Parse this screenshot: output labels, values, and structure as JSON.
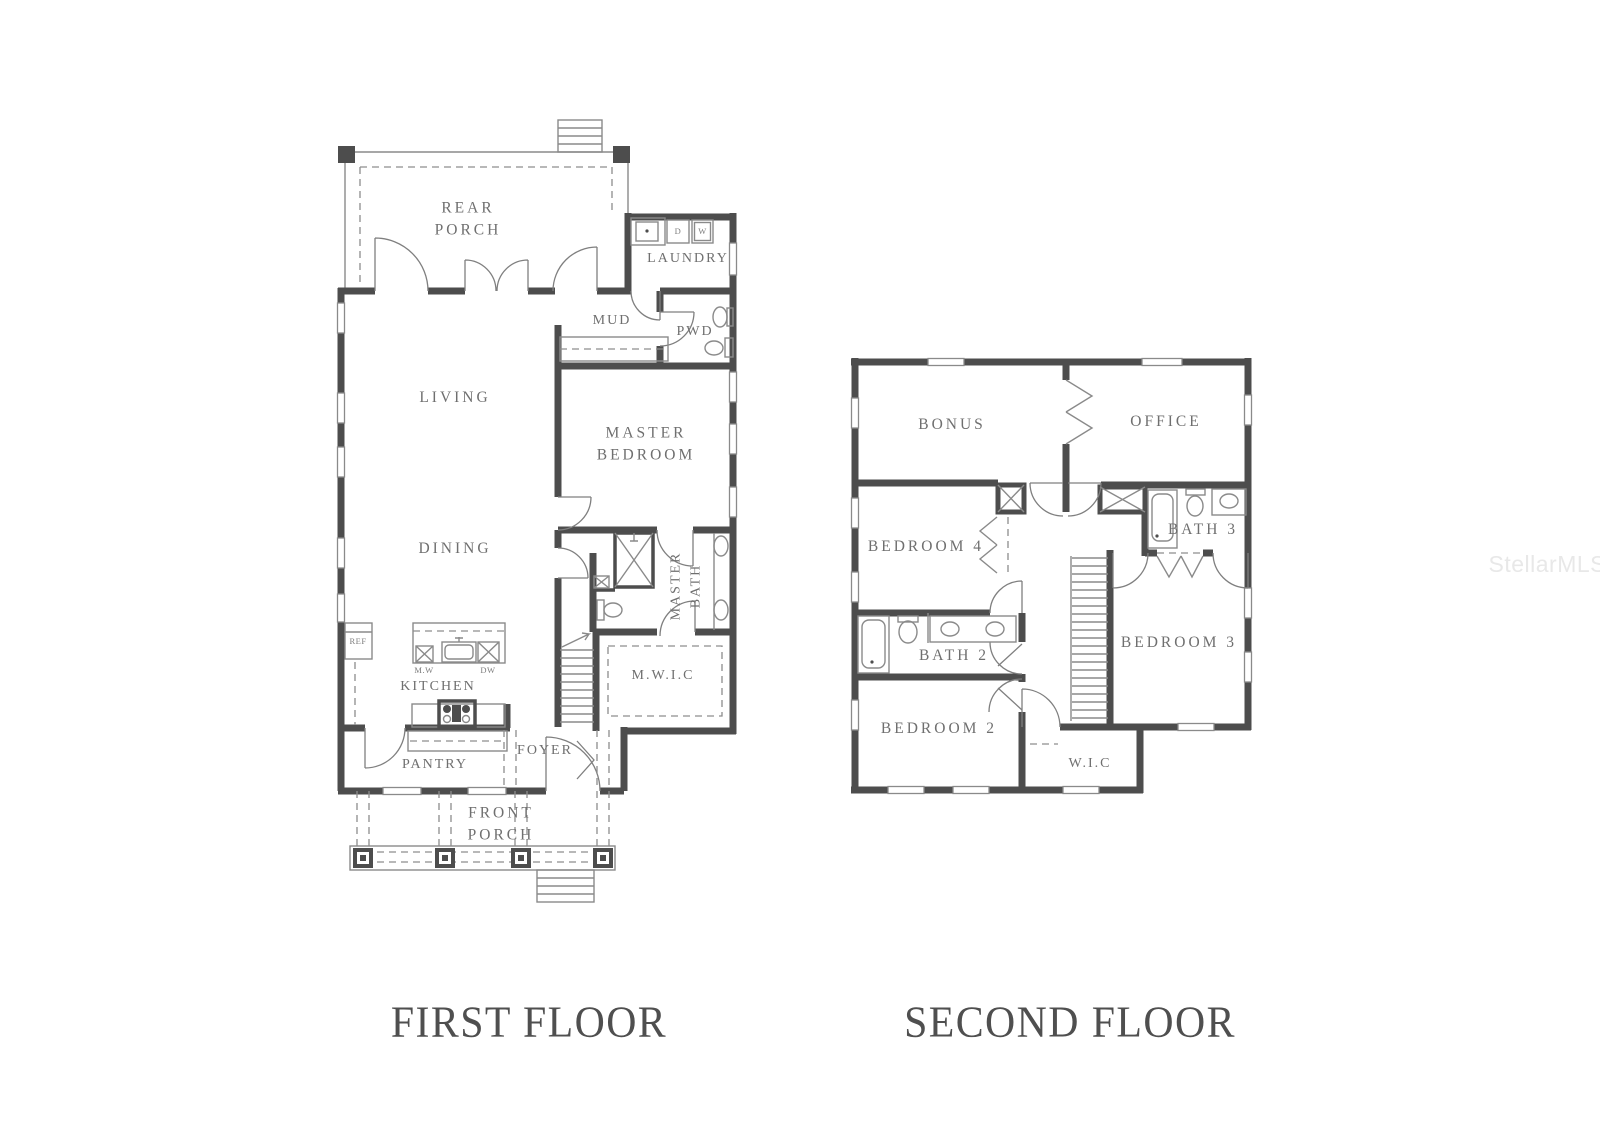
{
  "watermark": "StellarMLS",
  "colors": {
    "wall": "#4d4d4d",
    "thin_line": "#8a8a8a",
    "label_text": "#6f6f6f",
    "title_text": "#4f4f4f",
    "watermark_text": "#e8e8e8",
    "background": "#ffffff"
  },
  "first_floor": {
    "title": "FIRST FLOOR",
    "labels": {
      "rear_porch": "REAR\nPORCH",
      "laundry": "LAUNDRY",
      "mud": "MUD",
      "pwd": "PWD",
      "living": "LIVING",
      "master_bedroom": "MASTER\nBEDROOM",
      "dining": "DINING",
      "master_bath": "MASTER\nBATH",
      "mwic": "M.W.I.C",
      "kitchen": "KITCHEN",
      "microwave": "M.W",
      "dishwasher": "DW",
      "refrigerator": "REF",
      "dryer": "D",
      "washer": "W",
      "pantry": "PANTRY",
      "foyer": "FOYER",
      "front_porch": "FRONT\nPORCH"
    }
  },
  "second_floor": {
    "title": "SECOND FLOOR",
    "labels": {
      "bonus": "BONUS",
      "office": "OFFICE",
      "bedroom4": "BEDROOM 4",
      "bath3": "BATH 3",
      "bath2": "BATH 2",
      "bedroom3": "BEDROOM 3",
      "bedroom2": "BEDROOM 2",
      "wic": "W.I.C"
    }
  }
}
